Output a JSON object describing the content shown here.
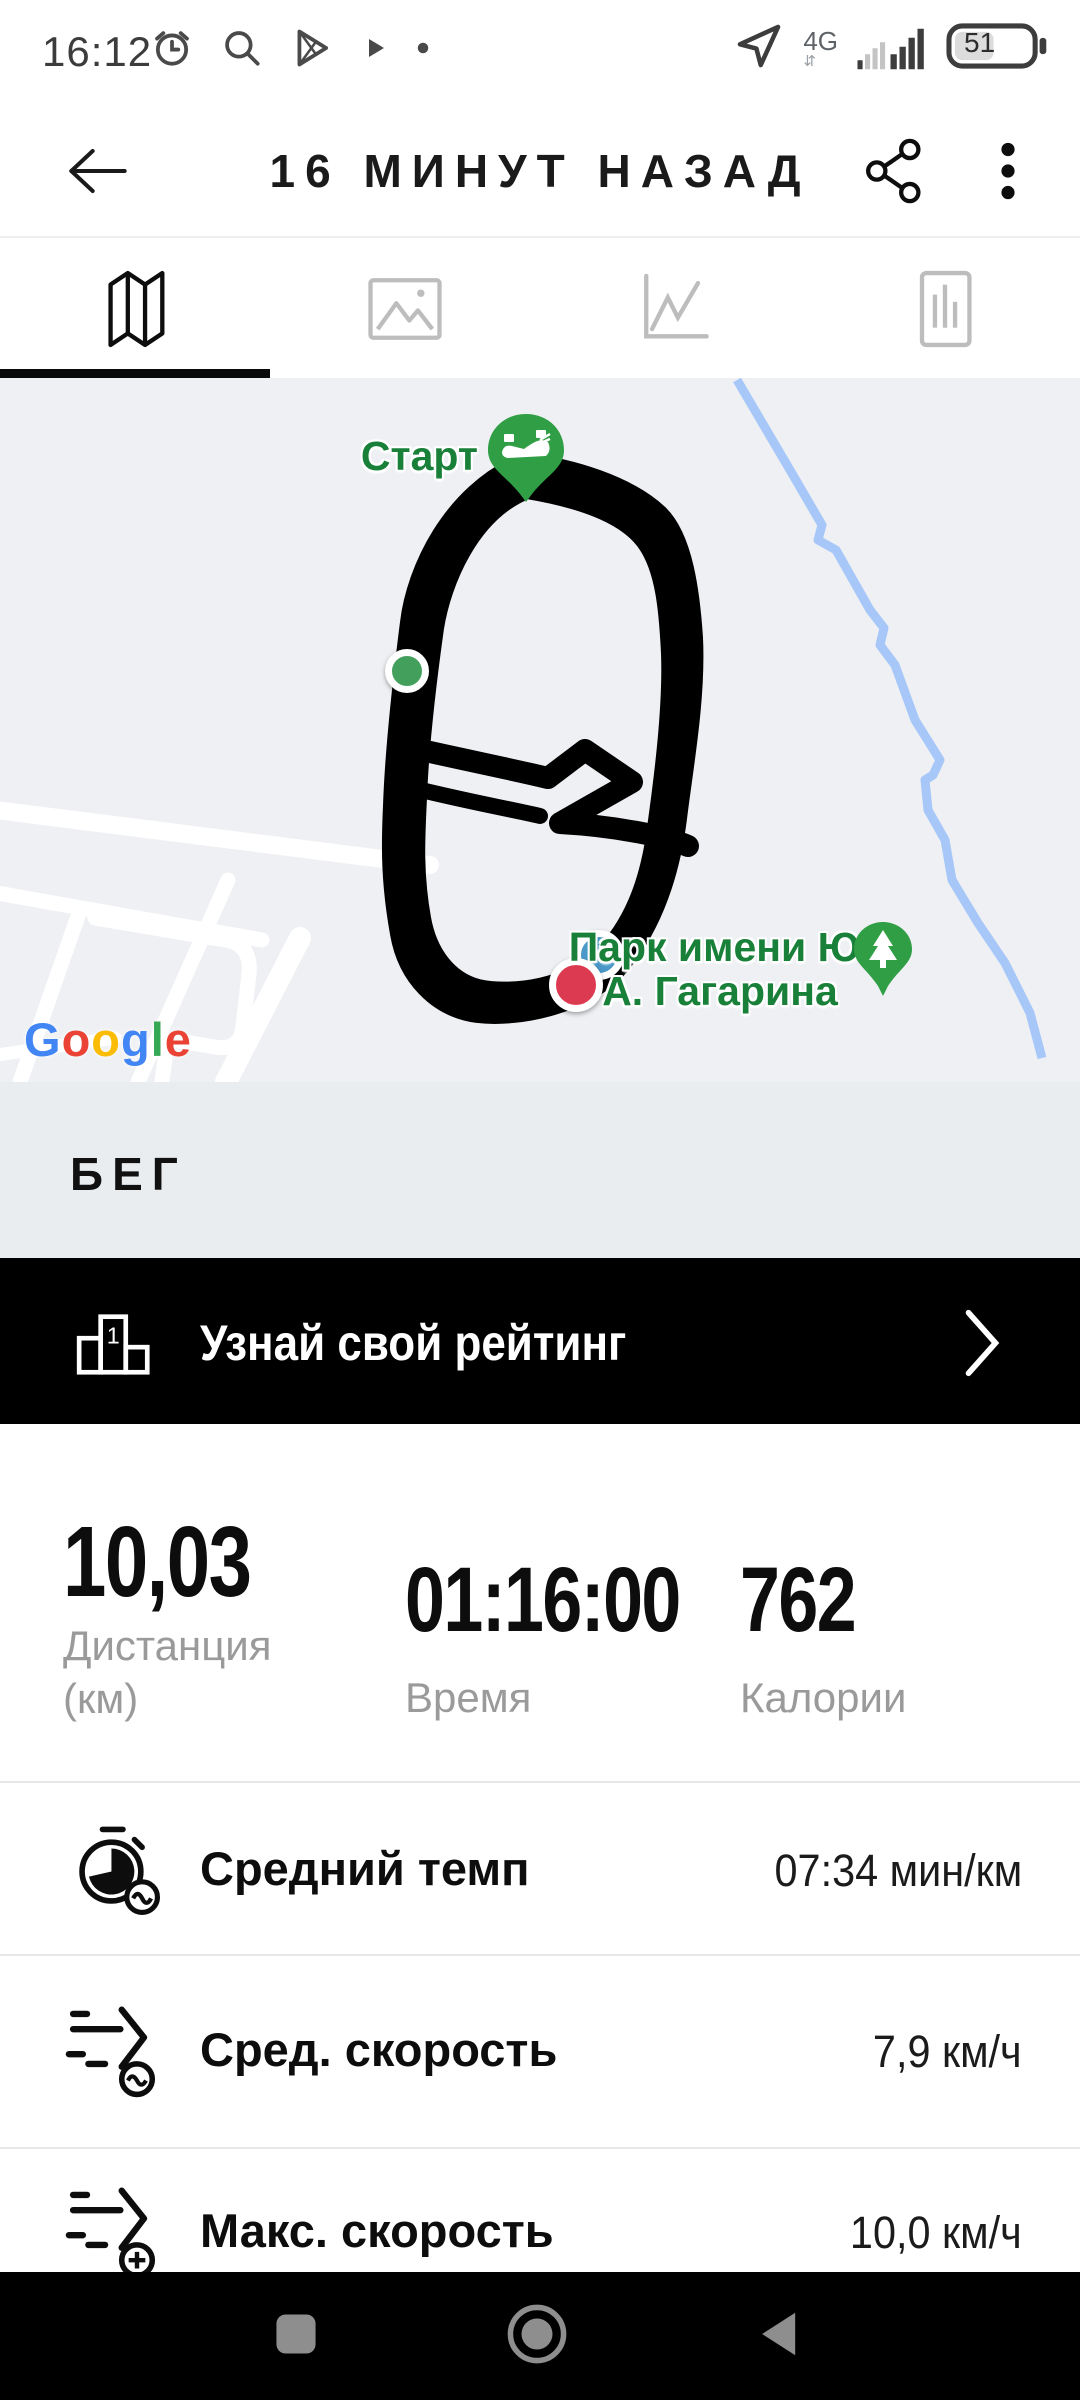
{
  "status_bar": {
    "time": "16:12",
    "network": "4G",
    "battery_percent": "51",
    "icons": [
      "alarm-icon",
      "search-icon",
      "play-store-icon",
      "play-small-icon",
      "notification-dot",
      "location-arrow-icon",
      "signal-bars",
      "battery-icon"
    ]
  },
  "header": {
    "title": "16 МИНУТ НАЗАД",
    "icons": [
      "back-arrow-icon",
      "share-icon",
      "overflow-menu-icon"
    ]
  },
  "tabs": {
    "items": [
      {
        "icon": "map-tab-icon",
        "active": true
      },
      {
        "icon": "photos-tab-icon",
        "active": false
      },
      {
        "icon": "line-chart-tab-icon",
        "active": false
      },
      {
        "icon": "bar-chart-tab-icon",
        "active": false
      }
    ]
  },
  "map": {
    "start_label": "Старт",
    "park_label_line1": "Парк имени Ю.",
    "park_label_line2": "А. Гагарина",
    "google_letters": [
      "G",
      "o",
      "o",
      "g",
      "l",
      "e"
    ],
    "markers": [
      "start-pin-shoe",
      "park-pin-tree",
      "position-green-dot",
      "position-blue-dot",
      "position-red-dot"
    ],
    "colors": {
      "label_green": "#188038",
      "pin_green": "#2f9e44",
      "route_black": "#000000",
      "river_blue": "#a7c7f9",
      "map_bg": "#eef0f3",
      "road_white": "#ffffff",
      "blue_dot": "#4a98c8",
      "red_dot": "#dc3a50",
      "green_dot": "#43a05c"
    }
  },
  "activity": {
    "type_label": "БЕГ"
  },
  "rating_banner": {
    "label": "Узнай свой рейтинг"
  },
  "stats": {
    "distance": {
      "value": "10,03",
      "label_line1": "Дистанция",
      "label_line2": "(км)"
    },
    "duration": {
      "value": "01:16:00",
      "label": "Время"
    },
    "calories": {
      "value": "762",
      "label": "Калории"
    }
  },
  "details": [
    {
      "icon": "avg-pace-icon",
      "label": "Средний темп",
      "value": "07:34 мин/км"
    },
    {
      "icon": "avg-speed-icon",
      "label": "Сред. скорость",
      "value": "7,9 км/ч"
    },
    {
      "icon": "max-speed-icon",
      "label": "Макс. скорость",
      "value": "10,0 км/ч"
    }
  ],
  "navbar": {
    "icons": [
      "recents-square-icon",
      "home-circle-icon",
      "back-triangle-icon"
    ]
  }
}
